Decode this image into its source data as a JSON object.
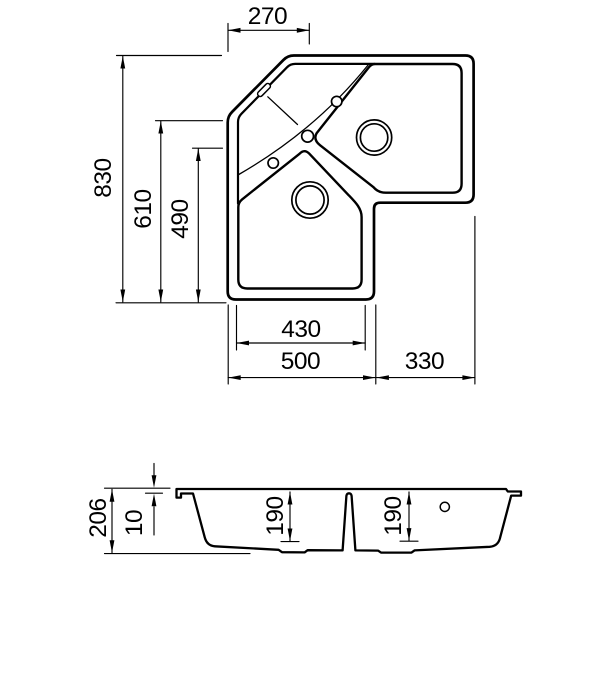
{
  "drawing": {
    "type": "corner kitchen sink technical drawing",
    "views": [
      "top view",
      "section view"
    ]
  },
  "top_view": {
    "dims": {
      "corner_width": "270",
      "overall_depth": "830",
      "left_edge_depth": "610",
      "bowl_length": "490",
      "bowl_width": "430",
      "left_width": "500",
      "right_width": "330"
    }
  },
  "section_view": {
    "dims": {
      "overall_height": "206",
      "rim_height": "10",
      "left_bowl_depth": "190",
      "right_bowl_depth": "190"
    }
  },
  "colors": {
    "line": "#000000",
    "background": "#ffffff"
  }
}
